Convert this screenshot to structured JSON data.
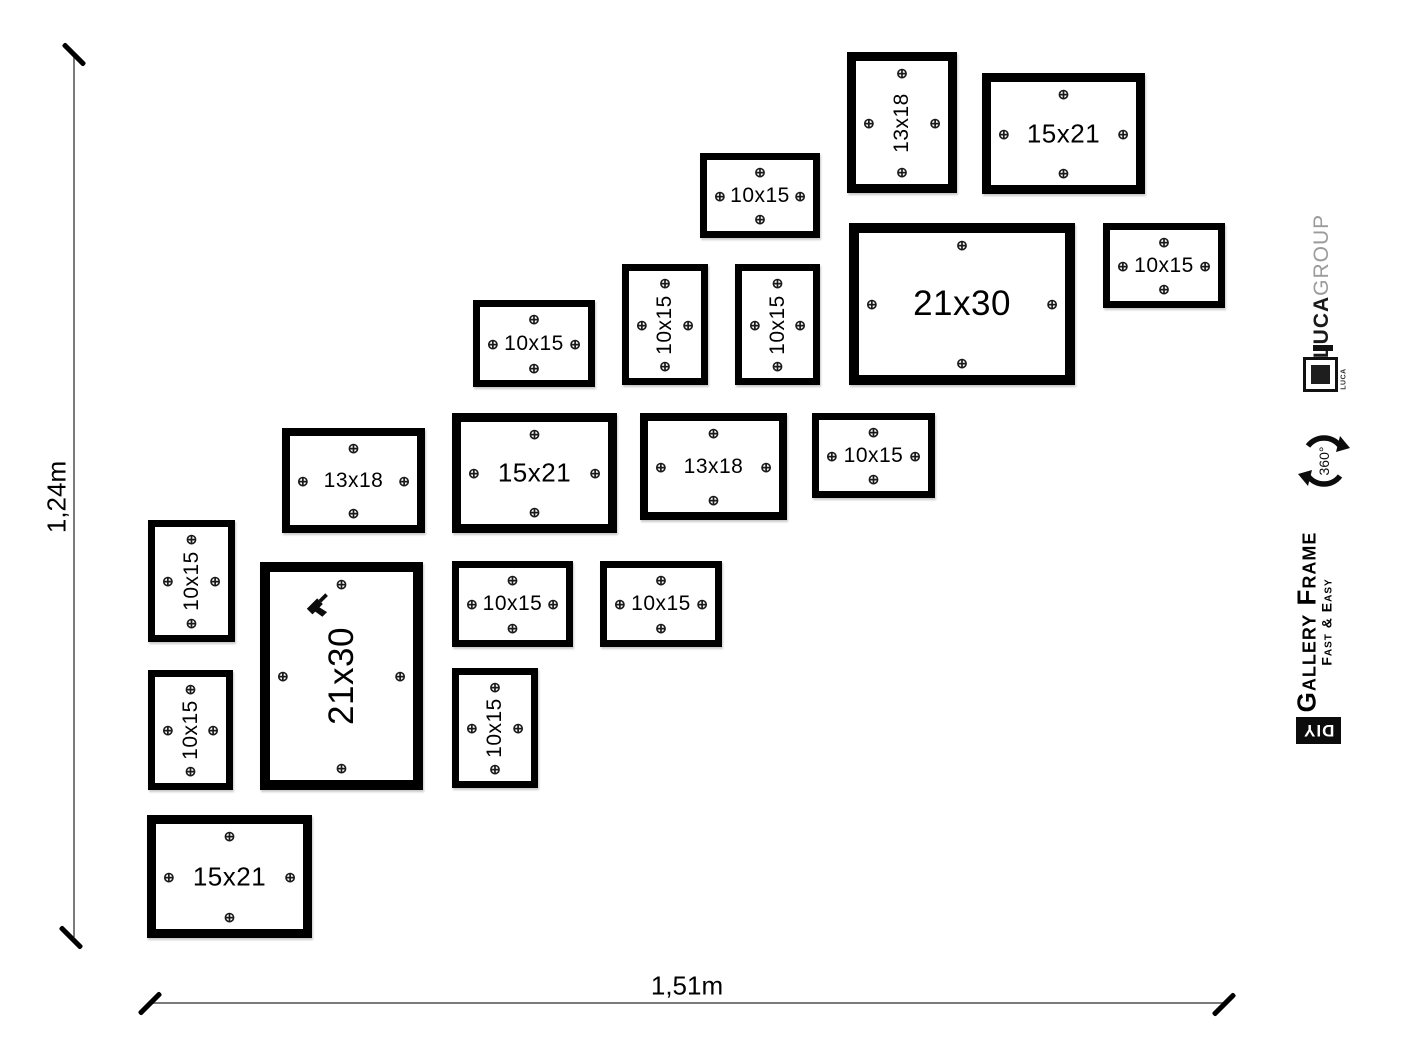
{
  "diagram": {
    "height_label": "1,24m",
    "width_label": "1,51m"
  },
  "branding": {
    "company_name_bold": "LUCA",
    "company_name_light": "GROUP",
    "logo_small_text": "LUCA",
    "rotation_badge": "360°",
    "product_name": "Gallery Frame",
    "product_tagline": "Fast & Easy",
    "diy_badge": "DIY"
  },
  "colors": {
    "frame_border": "#000000",
    "dimension_line": "#7b7b7b",
    "company_light_text": "#9b9b9b",
    "background": "#ffffff"
  },
  "screw_icon": "⊕",
  "frames": [
    {
      "size_label": "13x18",
      "x": 847,
      "y": 52,
      "w": 110,
      "h": 141,
      "border": 9,
      "orientation": "portrait",
      "label_px": 21
    },
    {
      "size_label": "15x21",
      "x": 982,
      "y": 73,
      "w": 163,
      "h": 121,
      "border": 9,
      "orientation": "landscape",
      "label_px": 26
    },
    {
      "size_label": "10x15",
      "x": 700,
      "y": 153,
      "w": 120,
      "h": 85,
      "border": 7,
      "orientation": "landscape",
      "label_px": 21
    },
    {
      "size_label": "21x30",
      "x": 849,
      "y": 223,
      "w": 226,
      "h": 162,
      "border": 10,
      "orientation": "landscape",
      "label_px": 35
    },
    {
      "size_label": "10x15",
      "x": 1103,
      "y": 223,
      "w": 122,
      "h": 85,
      "border": 7,
      "orientation": "landscape",
      "label_px": 21
    },
    {
      "size_label": "10x15",
      "x": 473,
      "y": 300,
      "w": 122,
      "h": 87,
      "border": 7,
      "orientation": "landscape",
      "label_px": 21
    },
    {
      "size_label": "10x15",
      "x": 622,
      "y": 264,
      "w": 86,
      "h": 121,
      "border": 7,
      "orientation": "portrait",
      "label_px": 21
    },
    {
      "size_label": "10x15",
      "x": 735,
      "y": 264,
      "w": 85,
      "h": 121,
      "border": 7,
      "orientation": "portrait",
      "label_px": 21
    },
    {
      "size_label": "13x18",
      "x": 282,
      "y": 428,
      "w": 143,
      "h": 105,
      "border": 8,
      "orientation": "landscape",
      "label_px": 21
    },
    {
      "size_label": "15x21",
      "x": 452,
      "y": 413,
      "w": 165,
      "h": 120,
      "border": 9,
      "orientation": "landscape",
      "label_px": 26
    },
    {
      "size_label": "13x18",
      "x": 640,
      "y": 413,
      "w": 147,
      "h": 107,
      "border": 8,
      "orientation": "landscape",
      "label_px": 21
    },
    {
      "size_label": "10x15",
      "x": 812,
      "y": 413,
      "w": 123,
      "h": 85,
      "border": 7,
      "orientation": "landscape",
      "label_px": 21
    },
    {
      "size_label": "10x15",
      "x": 148,
      "y": 520,
      "w": 87,
      "h": 122,
      "border": 7,
      "orientation": "portrait",
      "label_px": 21
    },
    {
      "size_label": "21x30",
      "x": 260,
      "y": 562,
      "w": 163,
      "h": 228,
      "border": 10,
      "orientation": "portrait",
      "label_px": 35,
      "drill": true
    },
    {
      "size_label": "10x15",
      "x": 452,
      "y": 561,
      "w": 121,
      "h": 86,
      "border": 7,
      "orientation": "landscape",
      "label_px": 21
    },
    {
      "size_label": "10x15",
      "x": 600,
      "y": 561,
      "w": 122,
      "h": 86,
      "border": 7,
      "orientation": "landscape",
      "label_px": 21
    },
    {
      "size_label": "10x15",
      "x": 148,
      "y": 670,
      "w": 85,
      "h": 120,
      "border": 7,
      "orientation": "portrait",
      "label_px": 21
    },
    {
      "size_label": "10x15",
      "x": 452,
      "y": 668,
      "w": 86,
      "h": 120,
      "border": 7,
      "orientation": "portrait",
      "label_px": 21
    },
    {
      "size_label": "15x21",
      "x": 147,
      "y": 815,
      "w": 165,
      "h": 123,
      "border": 9,
      "orientation": "landscape",
      "label_px": 26
    }
  ]
}
